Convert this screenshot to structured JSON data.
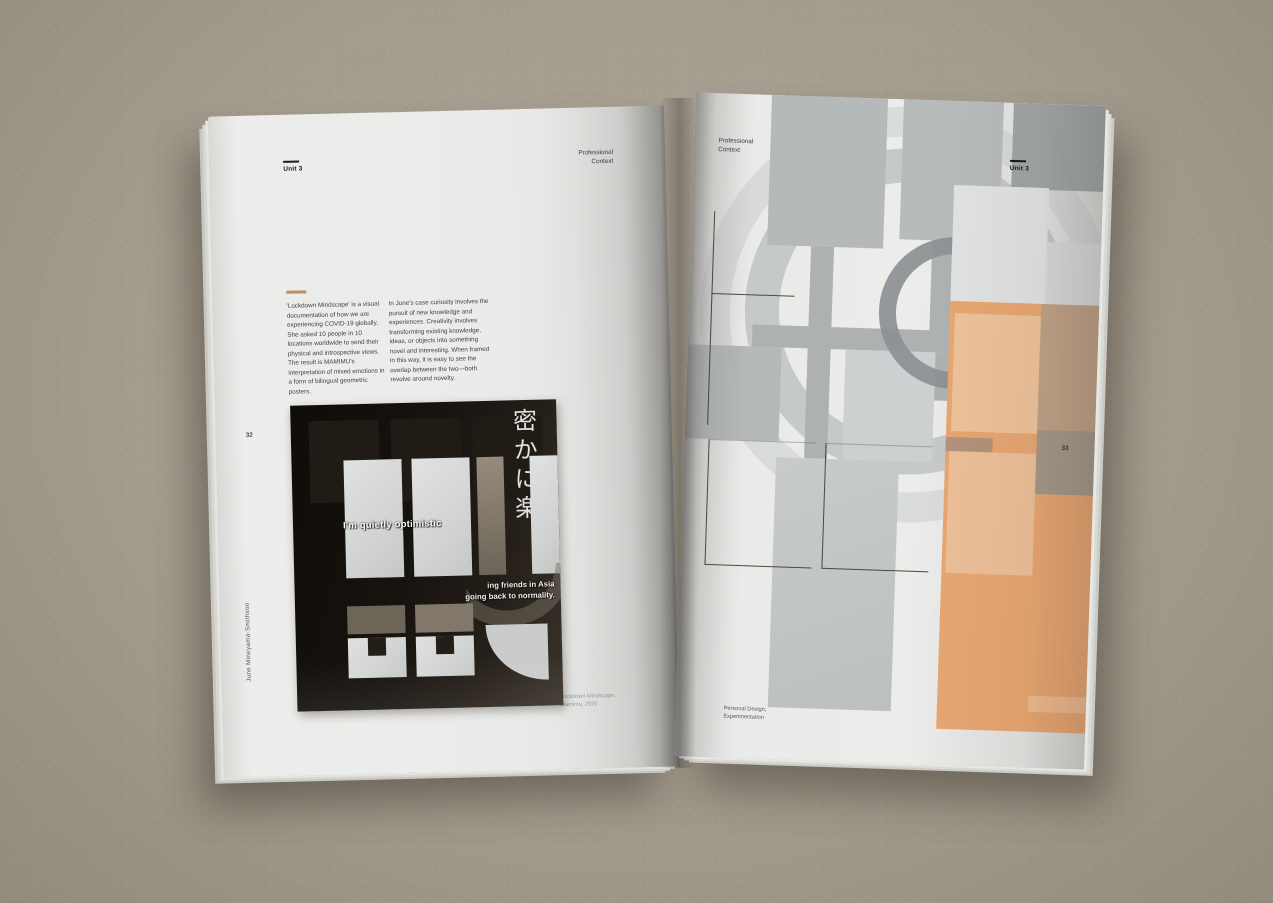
{
  "photo": {
    "surface_color": "#a49c8e",
    "description_colors": {
      "page_gray": "#ececea",
      "spine_shadow": "#5a554b"
    }
  },
  "left_page": {
    "unit_label": "Unit 3",
    "section_label_line1": "Professional",
    "section_label_line2": "Context",
    "accent_dash_color": "#c18b64",
    "intro_text": "'Lockdown Mindscape' is a visual documentation of how we are experiencing COVID-19 globally. She asked 10 people in 10 locations worldwide to send their physical and introspective views. The result is MAMIMU's interpretation of mixed emotions in a form of bilingual geometric posters.",
    "body_text": "In June's case curiosity involves the pursuit of new knowledge and experiences. Creativity involves transforming existing knowledge, ideas, or objects into something novel and interesting. When framed in this way, it is easy to see the overlap between the two—both revolve around novelty.",
    "page_number": "32",
    "credit_vertical": "June Mineyama-Smithson",
    "poster": {
      "jp_vertical_text": "密かに楽",
      "headline": "I'm quietly optimistic",
      "overlay_line1": "ing friends in Asia",
      "overlay_line2": "going back to normality.",
      "credit_line1": "Lockdown Mindscape,",
      "credit_line2": "Mamimu, 2020",
      "background_color": "#17120e",
      "light_square_color": "#d8dad9",
      "taupe_color": "#7c7368"
    }
  },
  "right_page": {
    "section_label_line1": "Professional",
    "section_label_line2": "Context",
    "unit_label": "Unit 3",
    "page_number": "33",
    "caption_line1": "Personal Design,",
    "caption_line2": "Experimentation",
    "artwork_colors": {
      "orange": "#e7a671",
      "peach": "#ecc09a",
      "gray_square": "#b8bbbc",
      "pale_square": "#e0e2e3",
      "tan_square": "#a5978a",
      "ring_dark": "#8d9092",
      "ring_light": "#c3c7c8"
    }
  }
}
